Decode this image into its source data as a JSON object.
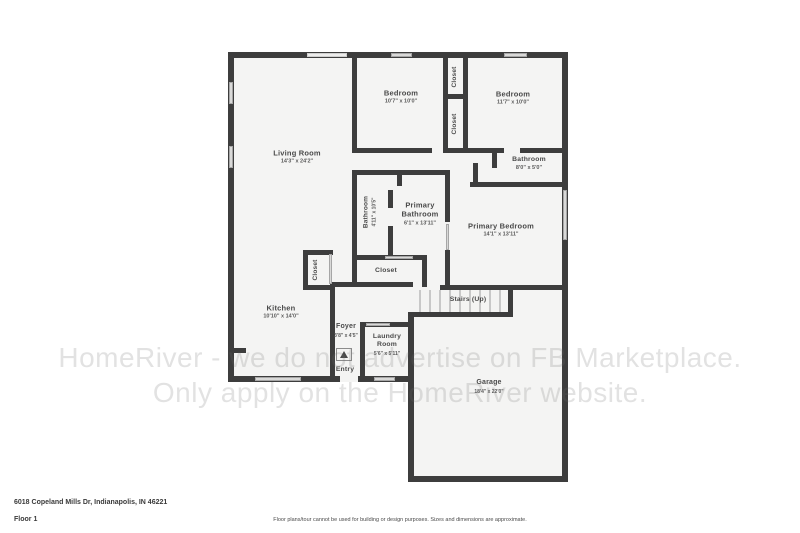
{
  "watermark": {
    "line1": "HomeRiver - we do not advertise on FB Marketplace.",
    "line2": "Only apply on the HomeRiver website."
  },
  "footer": {
    "address": "6018 Copeland Mills Dr, Indianapolis, IN 46221",
    "floor": "Floor 1",
    "disclaimer": "Floor plans/tour cannot be used for building or design purposes. Sizes and dimensions are approximate."
  },
  "rooms": {
    "living_room": {
      "name": "Living Room",
      "dims": "14'3\" x 24'2\""
    },
    "bedroom_left": {
      "name": "Bedroom",
      "dims": "10'7\" x 10'0\""
    },
    "bedroom_right": {
      "name": "Bedroom",
      "dims": "11'7\" x 10'0\""
    },
    "closet_upper": {
      "name": "Closet"
    },
    "closet_lower": {
      "name": "Closet"
    },
    "bathroom_hall": {
      "name": "Bathroom",
      "dims": "8'0\" x 5'0\""
    },
    "bathroom_small": {
      "name": "Bathroom",
      "dims": "4'11\" x 10'5\""
    },
    "primary_bathroom": {
      "name": "Primary Bathroom",
      "dims": "6'1\" x 13'11\""
    },
    "primary_bedroom": {
      "name": "Primary Bedroom",
      "dims": "14'1\" x 13'11\""
    },
    "closet_primary": {
      "name": "Closet"
    },
    "closet_kitchen": {
      "name": "Closet"
    },
    "stairs": {
      "name": "Stairs (Up)"
    },
    "kitchen": {
      "name": "Kitchen",
      "dims": "10'10\" x 14'0\""
    },
    "foyer": {
      "name": "Foyer",
      "dims": "3'8\" x 4'5\""
    },
    "laundry": {
      "name": "Laundry Room",
      "dims": "5'6\" x 5'11\""
    },
    "entry": {
      "name": "Entry"
    },
    "garage": {
      "name": "Garage",
      "dims": "18'4\" x 22'0\""
    }
  },
  "colors": {
    "wall": "#3d3d3d",
    "room_fill": "#f4f4f3",
    "window": "#d9d9d8"
  }
}
